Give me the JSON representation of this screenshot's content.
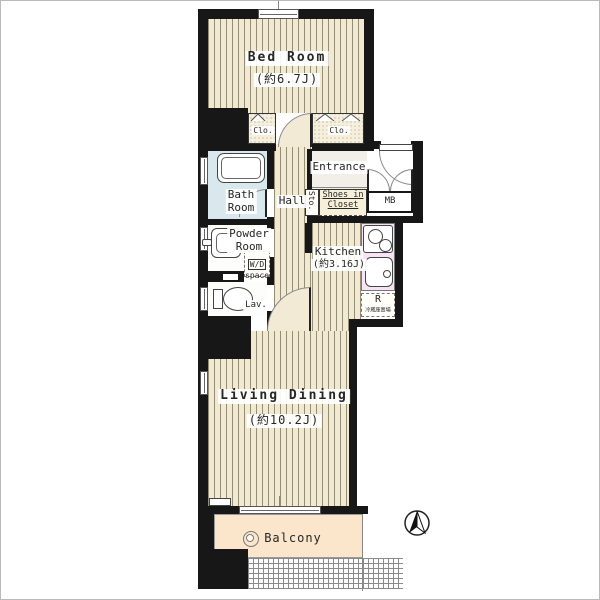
{
  "plan": {
    "bedroom": {
      "name": "Bed Room",
      "size": "(約6.7J)"
    },
    "closet_left": {
      "name": "Clo."
    },
    "closet_right": {
      "name": "Clo."
    },
    "bath": {
      "line1": "Bath",
      "line2": "Room"
    },
    "powder": {
      "line1": "Powder",
      "line2": "Room"
    },
    "wd_space": {
      "name": "W/D",
      "sub": "space"
    },
    "lav": {
      "name": "Lav."
    },
    "hall": {
      "name": "Hall"
    },
    "entrance": {
      "name": "Entrance"
    },
    "storage": {
      "name": "Sto."
    },
    "shoes_closet": {
      "line1": "Shoes in",
      "line2": "Closet"
    },
    "meter_box": {
      "name": "MB"
    },
    "kitchen": {
      "name": "Kitchen",
      "size": "(約3.16J)"
    },
    "fridge_space": {
      "name": "R",
      "note": "冷蔵庫置場"
    },
    "living": {
      "name": "Living Dining",
      "size": "(約10.2J)"
    },
    "balcony": {
      "name": "Balcony"
    }
  },
  "icons": {
    "compass": "north-arrow",
    "balcony_faucet": "drain-circle"
  },
  "colors": {
    "wall": "#171717",
    "floor": "#f2e9d1",
    "floor_line": "#948e78",
    "bath": "#d8e8ed",
    "kitchen_counter": "#f7e3f4",
    "balcony": "#fbe5cb",
    "closet": "#f6efd9"
  }
}
